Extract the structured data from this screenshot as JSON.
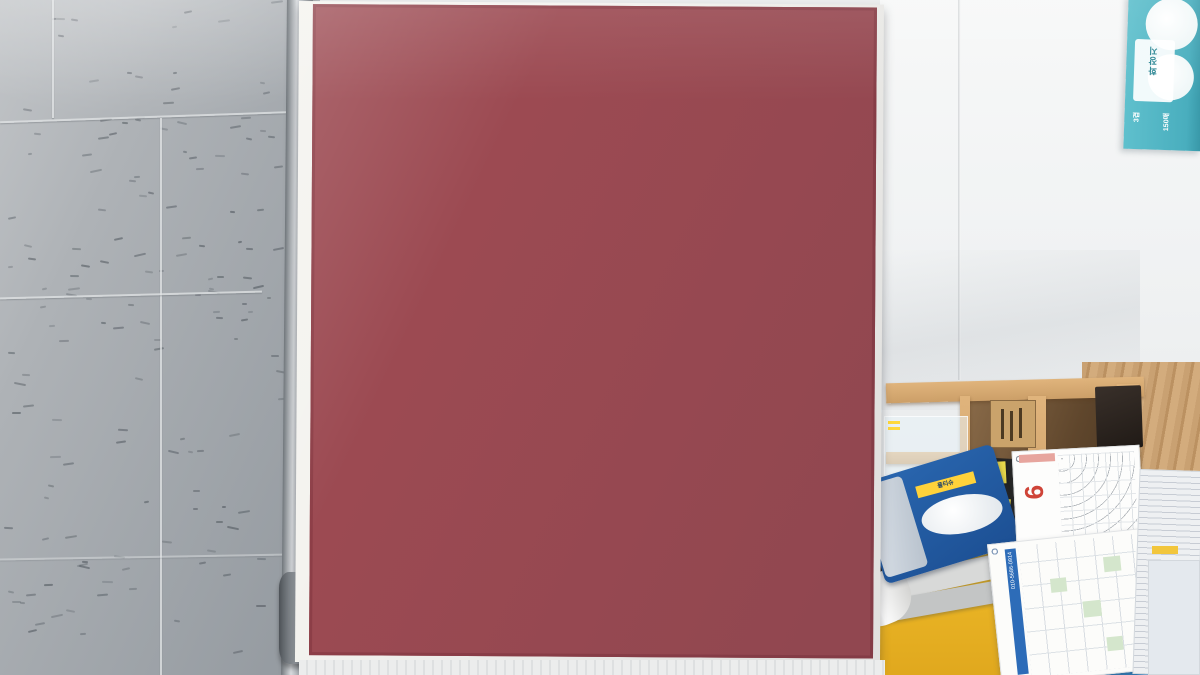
{
  "scene_title": "분양 안내 게시판",
  "poster": {
    "panels": {
      "cadastral": {
        "side_note": "택지개발지구 경계",
        "area_label": "장자동"
      },
      "top_middle": {
        "label": "원베이리 힐스테이트",
        "tag": "분양문의",
        "buildings": [
          "201동",
          "203동",
          "205동",
          "207동",
          "208동",
          "211동",
          "212동"
        ],
        "unit_sizes": [
          "34A",
          "34B",
          "34C",
          "34D"
        ]
      },
      "top_right": {
        "label": "자이 힐스테이트",
        "buildings": [
          "301동",
          "302동",
          "303동",
          "305동",
          "306동",
          "307동"
        ],
        "unit_sizes": [
          "34A",
          "34B",
          "34C"
        ]
      },
      "bottom_left": {
        "label": "센트럴 아이파크"
      },
      "bottom_middle": {
        "label": "원베이리 GS자이",
        "buildings": [
          "103동",
          "104동",
          "105동",
          "106동"
        ],
        "unit_sizes": [
          "84A",
          "84B",
          "84C",
          "84D"
        ]
      },
      "bottom_right": {
        "label": "원베이리 푸르지오",
        "buildings": [
          "501동",
          "502동",
          "503동",
          "505동"
        ],
        "unit_sizes": [
          "59A",
          "59B",
          "74A"
        ]
      }
    }
  },
  "desk": {
    "calendar_month": "6",
    "planner_phone": "010-5686-0914",
    "white_card_text": "K",
    "tissue_label": "물티슈",
    "teal_box": {
      "title": "화장지",
      "line1": "3겹",
      "line2": "150매"
    }
  },
  "colors": {
    "poster_frame": "#9c4a52",
    "banner_blue": "#24418f",
    "bin_yellow": "#e8b52a",
    "card_cyan": "#2ea7d8",
    "box_teal": "#49aebe"
  }
}
